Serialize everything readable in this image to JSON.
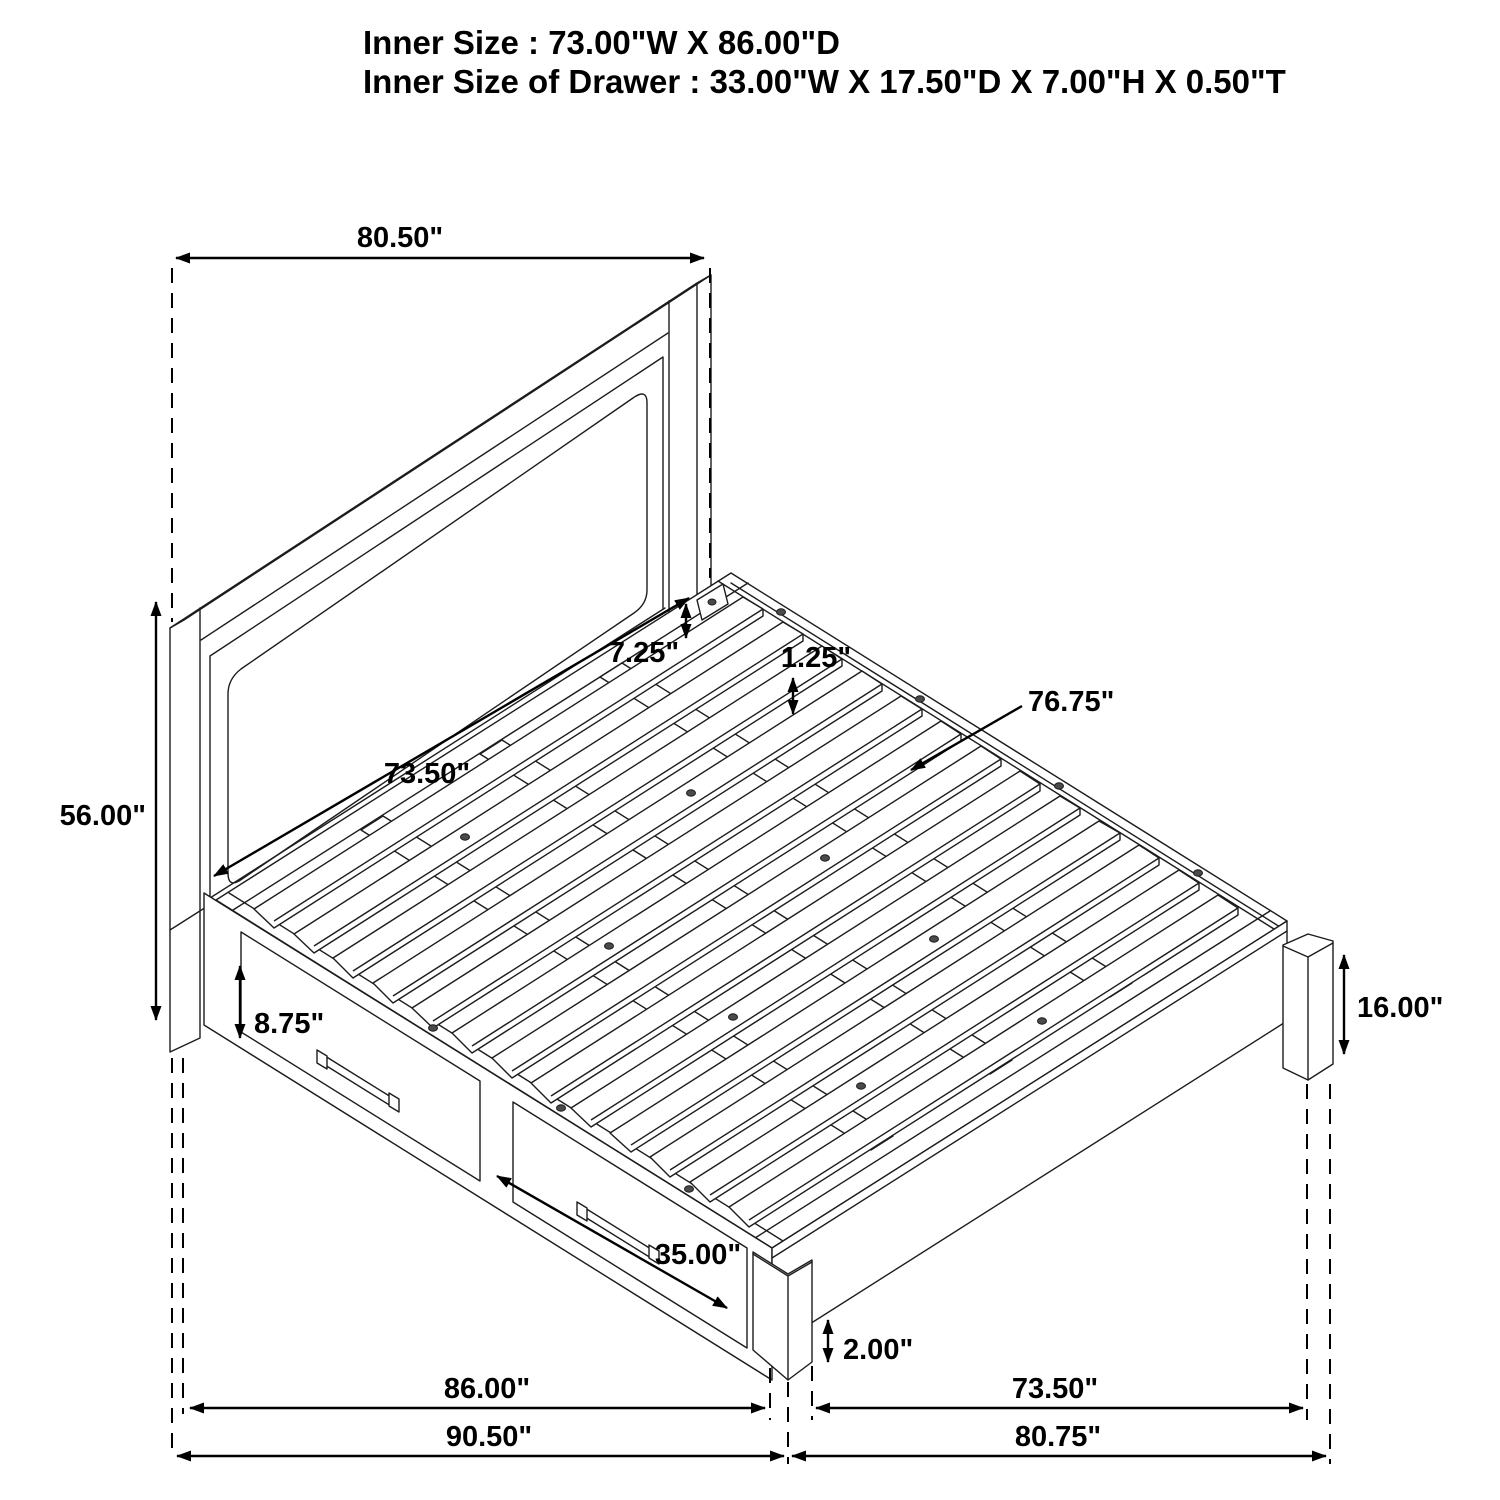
{
  "title": {
    "line1": "Inner Size : 73.00\"W X 86.00\"D",
    "line2": "Inner Size of Drawer : 33.00\"W X 17.50\"D X 7.00\"H X 0.50\"T"
  },
  "dimensions": {
    "headboard_width": "80.50\"",
    "headboard_height": "56.00\"",
    "rail_gap": "7.25\"",
    "slat_inset": "1.25\"",
    "headboard_inner_width": "73.50\"",
    "slat_length": "76.75\"",
    "drawer_front_height": "8.75\"",
    "drawer_front_width": "35.00\"",
    "footboard_height": "16.00\"",
    "ground_clearance": "2.00\"",
    "side_inner_length": "86.00\"",
    "side_overall_length": "90.50\"",
    "footboard_inner_width": "73.50\"",
    "footboard_overall_width": "80.75\""
  },
  "colors": {
    "line": "#1c1c1c",
    "background": "#ffffff"
  },
  "units": "inches"
}
